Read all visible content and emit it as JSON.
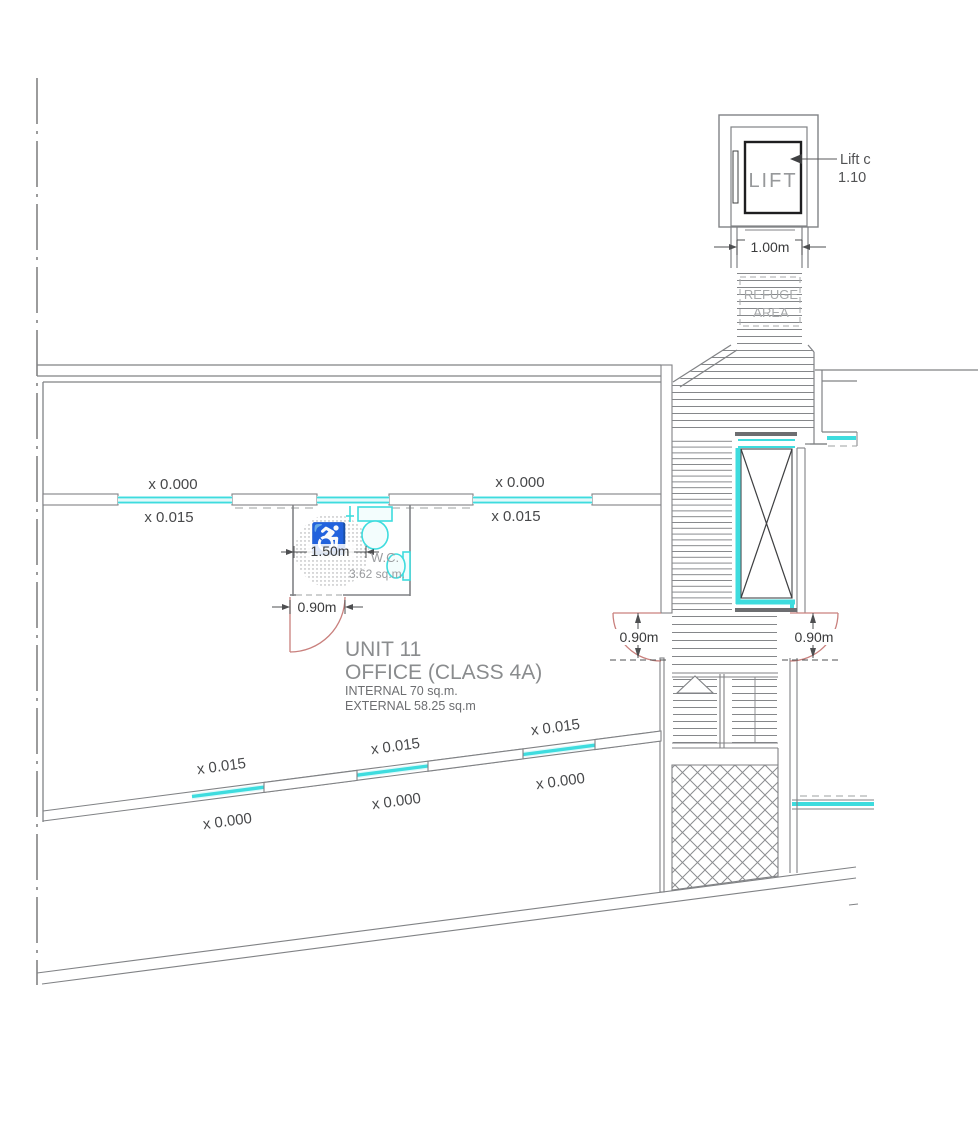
{
  "plan": {
    "unit": {
      "title": "UNIT 11",
      "use_class": "OFFICE (CLASS 4A)",
      "internal_area": "INTERNAL 70 sq.m.",
      "external_area": "EXTERNAL 58.25 sq.m"
    },
    "lift": {
      "label": "LIFT",
      "note_line1": "Lift c",
      "note_line2": "1.10"
    },
    "refuge": {
      "line1": "REFUGE",
      "line2": "AREA"
    },
    "wc": {
      "label": "W.C.",
      "area": "3.62 sq.m."
    },
    "dims": {
      "lobby_width": "1.00m",
      "turning_circle": "1.50m",
      "wc_door": "0.90m",
      "exit_left": "0.90m",
      "exit_right": "0.90m"
    },
    "levels": {
      "zero": "x 0.000",
      "fifteen": "x 0.015"
    },
    "icons": {
      "wheelchair": "♿"
    },
    "colors": {
      "glazing": "#3edcde",
      "glazing_fill": "#e2f9fa",
      "door_swing": "#c9807d",
      "wall": "#808285",
      "wall_dark": "#58595b",
      "lift_car": "#1e1e20",
      "text_gray": "#97999b",
      "text_dim": "#3a3b3c",
      "text_light": "#a7a9ab"
    }
  }
}
